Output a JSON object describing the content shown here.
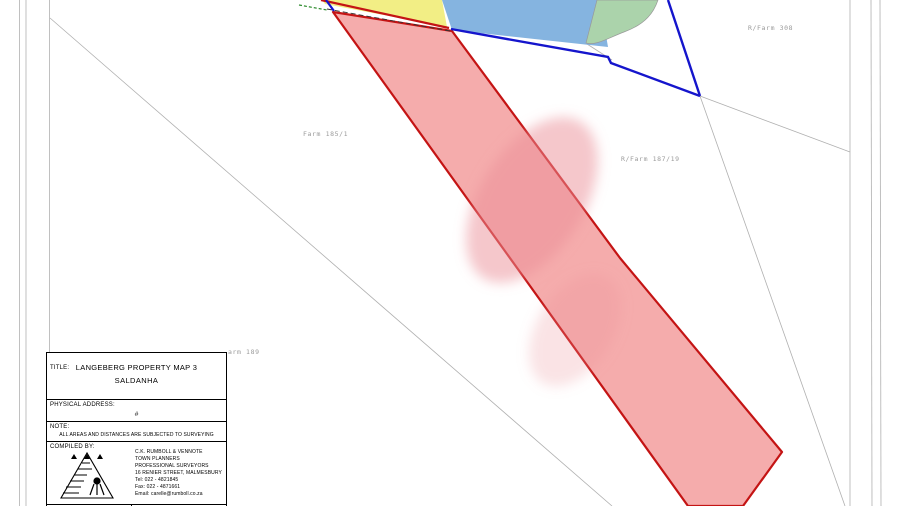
{
  "colors": {
    "parcel_pink_fill": "#f5acac",
    "parcel_pink_border": "#c41414",
    "parcel_yellow": "#f2ee85",
    "parcel_blue": "#85b4e0",
    "parcel_green": "#abd3ab",
    "boundary_blue": "#1515cc",
    "boundary_red": "#c41414",
    "boundary_gray": "#b0b0b0",
    "label_gray": "#9a9a9a",
    "blur_blob": "#ec8f98"
  },
  "map": {
    "labels": [
      {
        "text": "Farm 185/1"
      },
      {
        "text": "R/Farm 187/19"
      },
      {
        "text": "R/Farm 308"
      },
      {
        "text": "arm 189"
      }
    ]
  },
  "title_block": {
    "title_label": "TITLE:",
    "title_line1": "LANGEBERG PROPERTY MAP 3",
    "title_line2": "SALDANHA",
    "physical_address_label": "PHYSICAL ADDRESS:",
    "physical_address_value": "#",
    "note_label": "NOTE:",
    "note_text": "ALL AREAS AND DISTANCES ARE SUBJECTED TO SURVEYING",
    "compiled_by_label": "COMPILED BY:",
    "company": {
      "name": "C.K. RUMBOLL & VENNOTE",
      "line2": "TOWN PLANNERS",
      "line3": "PROFESSIONAL SURVEYORS",
      "line4": "16 RENIER STREET, MALMESBURY",
      "tel": "Tel: 022 - 4821845",
      "fax": "Fax: 022 - 4871661",
      "email": "Email: carelle@rumboll.co.za"
    },
    "date_label": "DATE:",
    "authority_label": "AUTHORITY:"
  }
}
